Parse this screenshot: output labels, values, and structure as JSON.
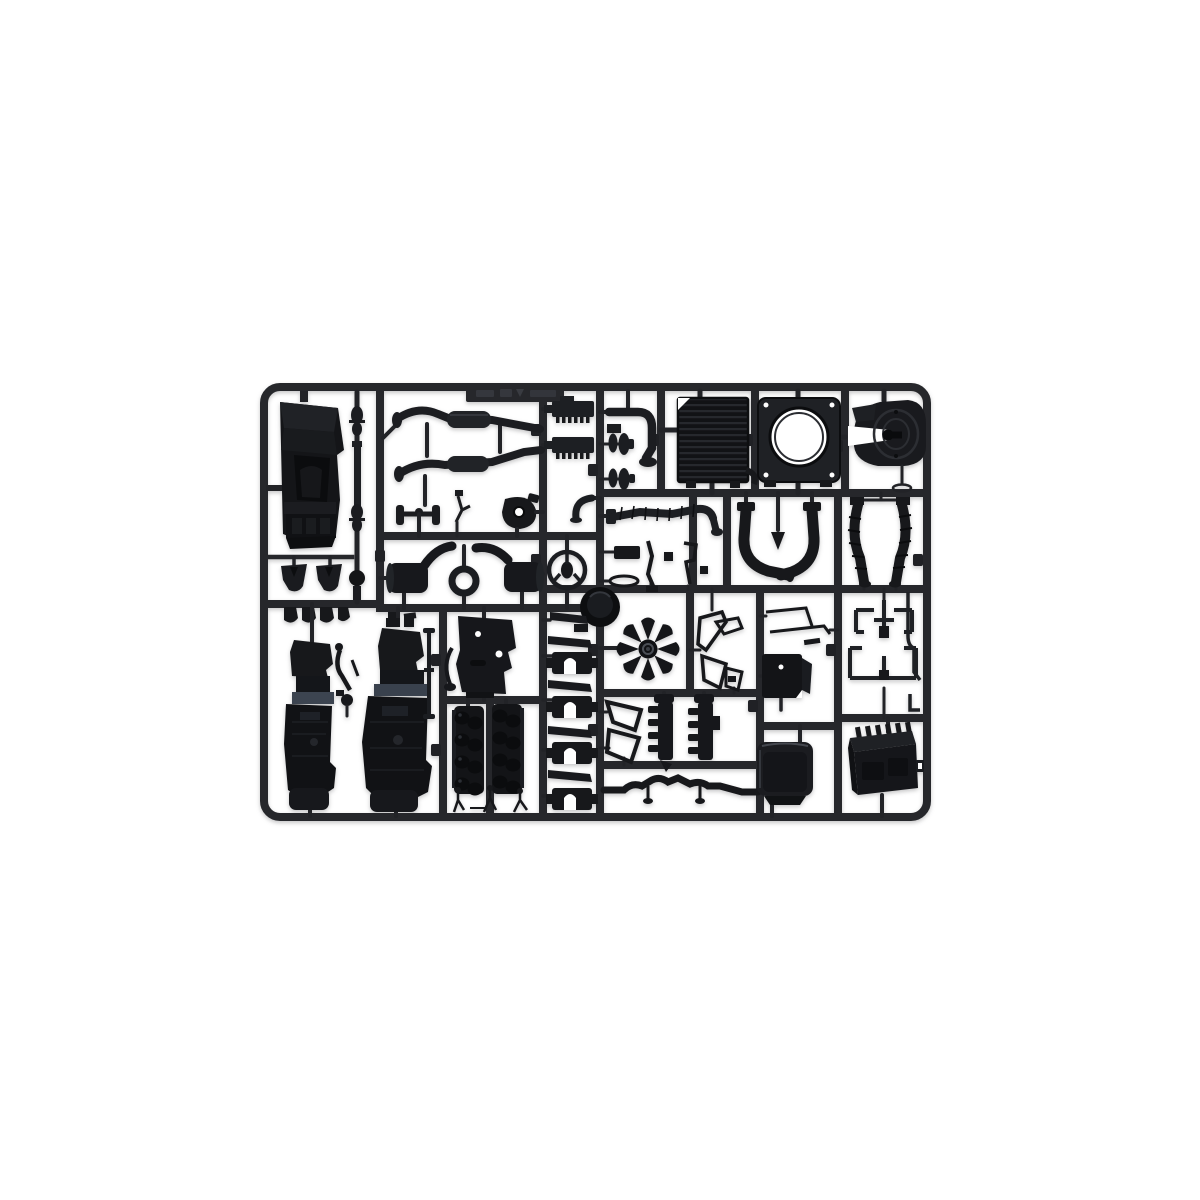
{
  "scene": {
    "description": "Product photograph of an injection-moulded black styrene model-kit sprue (parts tree) for a truck model kit, shown flat and centred on a plain white background.",
    "object": "model kit sprue",
    "material": "black styrene plastic",
    "background": "white"
  },
  "palette": {
    "background": "#ffffff",
    "plastic_dark": "#131417",
    "plastic_mid": "#1b1c20",
    "runner": "#26272b",
    "highlight": "#45484f",
    "engine_tint": "#3c4450",
    "hole_white": "#fdfdfd"
  },
  "parts": {
    "frame": "rectangular sprue frame with rounded corners",
    "tag": "embossed part-number tag (illegible)",
    "cab": "truck cab shell",
    "driveshaft": "drive shaft with universal joints",
    "exhaust_upper": "exhaust pipe with muffler (upper)",
    "exhaust_lower": "exhaust pipe with muffler (lower)",
    "handlebar": "cross-bar linkage",
    "pump": "pump housing with bore",
    "linkage": "small linkage twig",
    "spring_1": "leaf spring pack (upper)",
    "spring_2": "leaf spring pack (lower)",
    "elbow_pipe": "curved exhaust elbow",
    "pulleys": "belt pulley spools",
    "radiator": "ribbed radiator core",
    "fan_shroud": "fan shroud with circular opening",
    "fifth_wheel": "fifth-wheel coupling plate with pin",
    "mounts": "trapezoid engine mounts",
    "clips": "small mounting clips",
    "muffler_left": "silencer with curved pipe (left)",
    "gasket_ring": "ring seal",
    "muffler_right": "silencer with curved pipe (right)",
    "steering_wheel": "steering wheel",
    "gate_boss": "central sprue gate boss",
    "ribbed_hose": "ribbed radiator hose",
    "elbow_small": "small elbow pipe",
    "fittings": "assorted small fittings",
    "intake_left": "air intake pipe (left)",
    "intake_right": "air intake pipe (right)",
    "hanger": "spade-shaped hanger",
    "corrugated_hoses": "corrugated flexible hoses",
    "engine_left": "engine block half (left)",
    "engine_right": "engine block half (right)",
    "gear_lever": "gear lever linkage",
    "tie_rod": "tie rod",
    "aux_gearbox": "auxiliary gearbox with lever",
    "cyl_bank_1": "cylinder bank with valve gear (1)",
    "cyl_bank_2": "cylinder bank with valve gear (2)",
    "sprue_bits": "small sprue gate pieces",
    "fan": "eight-blade radiator fan",
    "saddle_mounts": "saddle mounting brackets",
    "grab_handles": "grab handle brackets",
    "mirror_brackets": "mirror bracket frames",
    "manifold_1": "exhaust manifold (1)",
    "manifold_2": "exhaust manifold (2)",
    "crossmember": "chassis cross member",
    "linkage_rods": "thin linkage rods",
    "mount_plate": "mounting plate",
    "air_tank": "air tank cover box",
    "air_lines": "air line pipe runs",
    "battery_box": "battery box with cooling fins",
    "air_pipe": "thin air pipe"
  }
}
